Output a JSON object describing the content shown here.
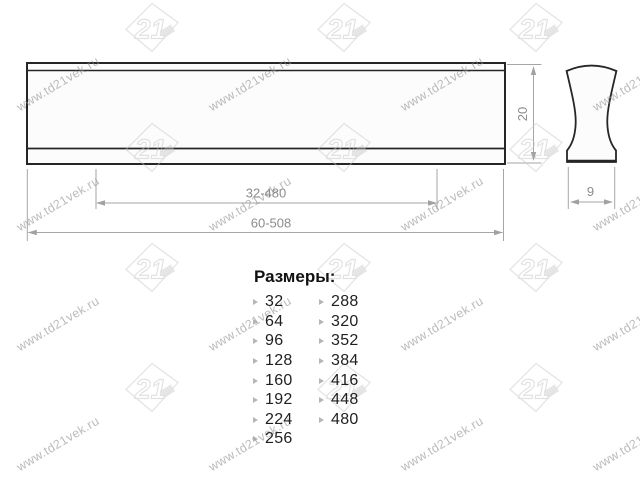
{
  "watermark": {
    "site_text": "www.td21vek.ru",
    "logo_text": "21"
  },
  "drawing": {
    "front_view": {
      "hole_distance_label": "32-480",
      "overall_length_label": "60-508",
      "height_label": "20"
    },
    "side_view": {
      "depth_label": "9"
    }
  },
  "sizes": {
    "heading": "Размеры:",
    "col1": [
      "32",
      "64",
      "96",
      "128",
      "160",
      "192",
      "224",
      "256"
    ],
    "col2": [
      "288",
      "320",
      "352",
      "384",
      "416",
      "448",
      "480"
    ]
  },
  "colors": {
    "outline": "#262626",
    "fill": "#fcfcfc",
    "dimension_line": "#a6a6a6",
    "dimension_text": "#8c8c8c",
    "list_text": "#1f1f1f",
    "watermark": "#8a8a8a"
  }
}
